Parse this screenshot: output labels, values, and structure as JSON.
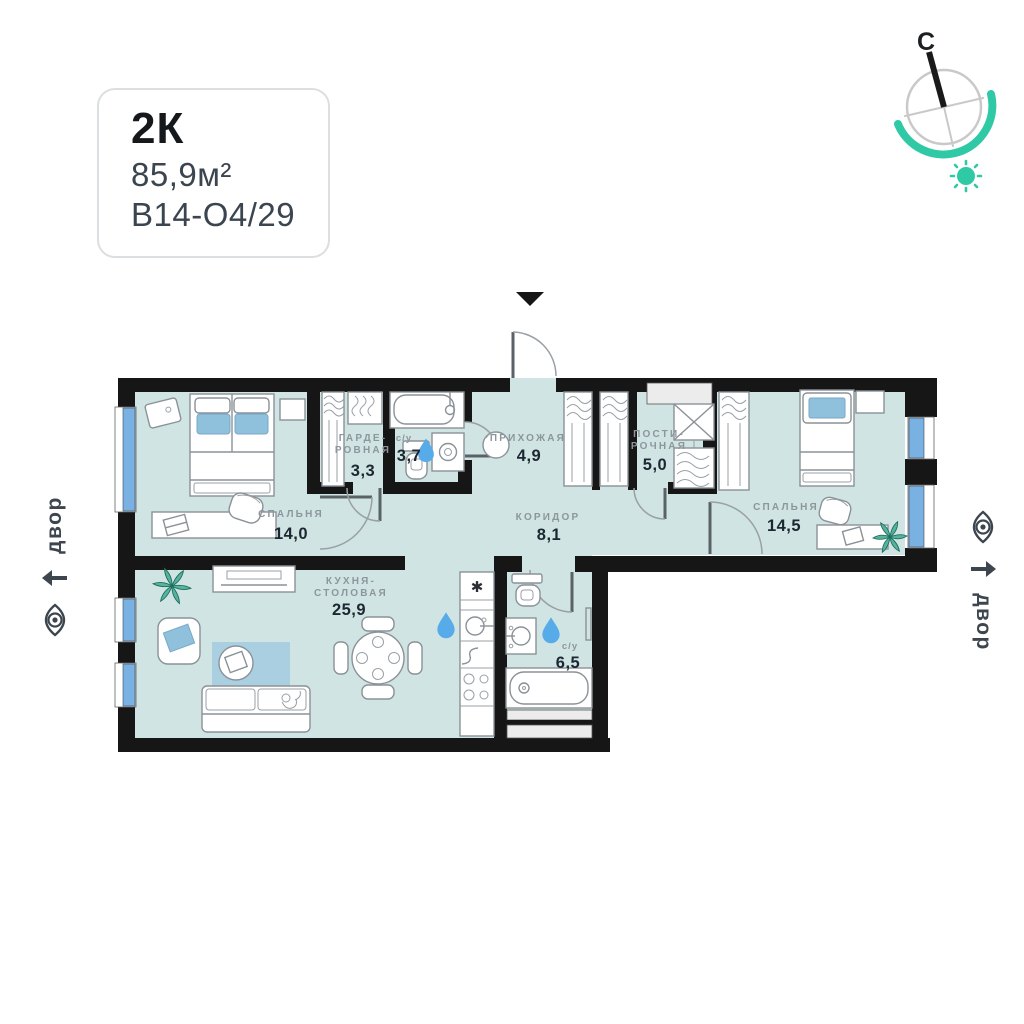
{
  "card": {
    "type": "2К",
    "area": "85,9м²",
    "code": "В14-О4/29"
  },
  "compass": {
    "north_label": "С"
  },
  "courtyard_left": {
    "label": "двор"
  },
  "courtyard_right": {
    "label": "двор"
  },
  "rooms": {
    "bedroom1": {
      "name": "СПАЛЬНЯ",
      "area": "14,0"
    },
    "wardrobe": {
      "name_line1": "ГАРДЕ-",
      "name_line2": "РОВНАЯ",
      "area": "3,3"
    },
    "bathroom_small": {
      "name": "с/у",
      "area": "3,7"
    },
    "hallway": {
      "name": "ПРИХОЖАЯ",
      "area": "4,9"
    },
    "laundry": {
      "name_line1": "ПОСТИ-",
      "name_line2": "РОЧНАЯ",
      "area": "5,0"
    },
    "bedroom2": {
      "name": "СПАЛЬНЯ",
      "area": "14,5"
    },
    "corridor": {
      "name": "КОРИДОР",
      "area": "8,1"
    },
    "kitchen": {
      "name_line1": "КУХНЯ-",
      "name_line2": "СТОЛОВАЯ",
      "area": "25,9",
      "fridge_marker": "✱"
    },
    "bathroom_big": {
      "name": "с/у",
      "area": "6,5"
    }
  },
  "colors": {
    "accent_teal": "#2fc9a6",
    "floor": "#cfe4e3",
    "wall": "#161616",
    "window_glass": "#79b1e2",
    "water_drop": "#57abe9",
    "label_gray": "#8d969d",
    "number_dark": "#1d2731"
  }
}
